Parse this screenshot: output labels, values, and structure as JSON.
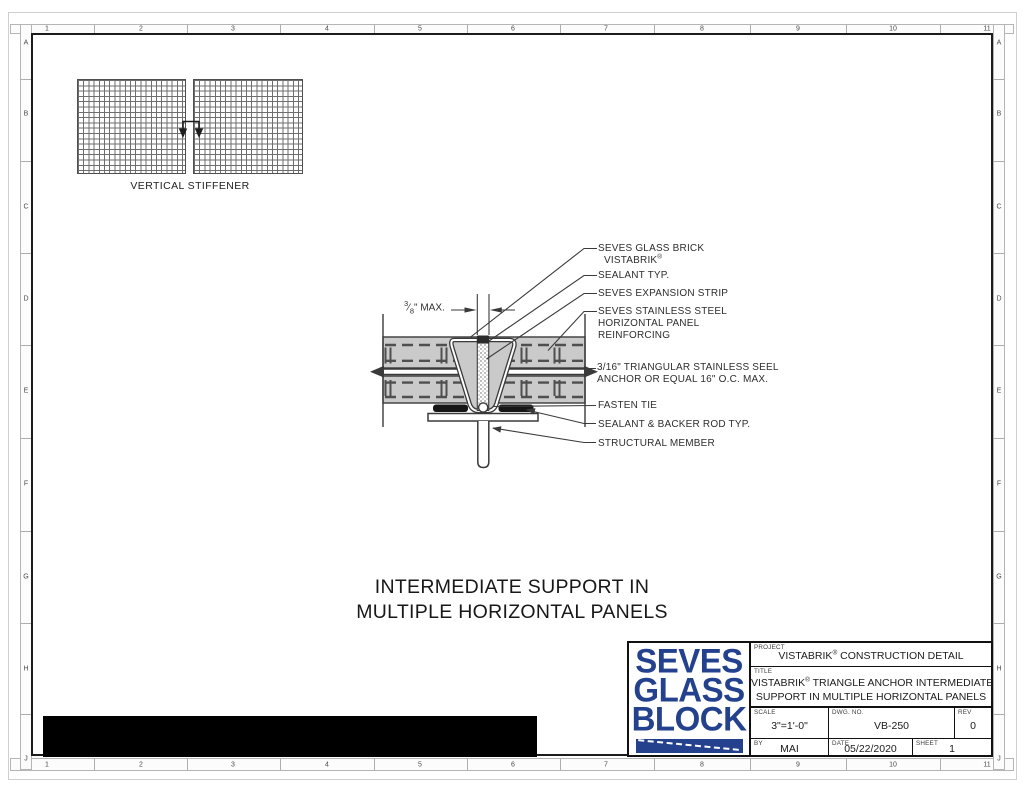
{
  "sheet": {
    "rulers": {
      "columns": [
        "1",
        "2",
        "3",
        "4",
        "5",
        "6",
        "7",
        "8",
        "9",
        "10",
        "11"
      ],
      "rows": [
        "A",
        "B",
        "C",
        "D",
        "E",
        "F",
        "G",
        "H",
        "J"
      ]
    },
    "stiffener": {
      "label": "VERTICAL STIFFENER"
    },
    "dimension": {
      "numerator": "3",
      "slash": "⁄",
      "denominator": "8",
      "suffix": "\" MAX."
    },
    "callouts": {
      "glass_brick": {
        "line1": "SEVES GLASS BRICK",
        "line2": "VISTABRIK",
        "reg": "®"
      },
      "sealant": {
        "line1": "SEALANT TYP."
      },
      "expansion_strip": {
        "line1": "SEVES EXPANSION STRIP"
      },
      "reinforcing": {
        "line1": "SEVES STAINLESS STEEL",
        "line2": "HORIZONTAL PANEL",
        "line3": "REINFORCING"
      },
      "anchor": {
        "line1": "3/16\" TRIANGULAR STAINLESS SEEL",
        "line2": "ANCHOR OR EQUAL 16\" O.C. MAX."
      },
      "fasten_tie": {
        "line1": "FASTEN TIE"
      },
      "backer_rod": {
        "line1": "SEALANT & BACKER ROD TYP."
      },
      "structural_member": {
        "line1": "STRUCTURAL MEMBER"
      }
    },
    "caption": {
      "line1": "INTERMEDIATE SUPPORT IN",
      "line2": "MULTIPLE HORIZONTAL PANELS"
    }
  },
  "title_block": {
    "logo": {
      "line1": "SEVES",
      "line2": "GLASS",
      "line3": "BLOCK"
    },
    "project": {
      "label": "PROJECT",
      "pre": "VISTABRIK",
      "reg": "®",
      "post": " CONSTRUCTION DETAIL"
    },
    "title": {
      "label": "TITLE",
      "line1_pre": "VISTABRIK",
      "reg": "®",
      "line1_post": " TRIANGLE ANCHOR INTERMEDIATE",
      "line2": "SUPPORT IN MULTIPLE HORIZONTAL PANELS"
    },
    "scale": {
      "label": "SCALE",
      "value": "3\"=1'-0\""
    },
    "dwg_no": {
      "label": "DWG. NO.",
      "value": "VB-250"
    },
    "rev": {
      "label": "REV",
      "value": "0"
    },
    "by": {
      "label": "BY",
      "value": "MAI"
    },
    "date": {
      "label": "DATE",
      "value": "05/22/2020"
    },
    "sheet_no": {
      "label": "SHEET",
      "value": "1"
    }
  },
  "colors": {
    "logo_blue": "#24418e",
    "panel_gray": "#cacaca",
    "line": "#3a3a3a"
  }
}
